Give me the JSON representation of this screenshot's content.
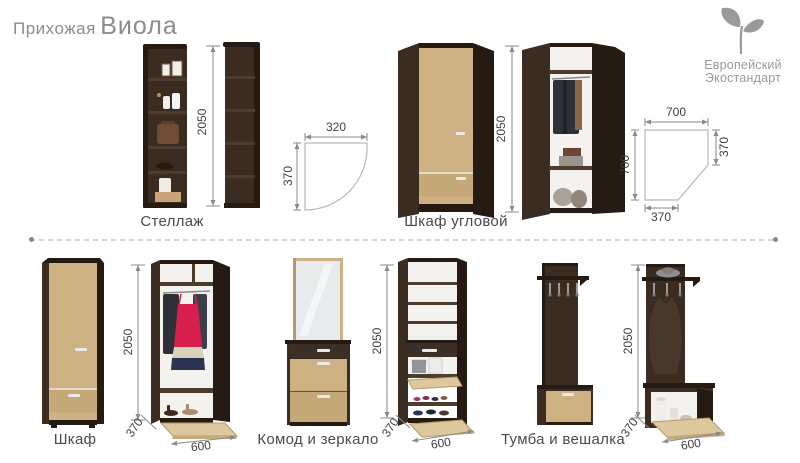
{
  "title": {
    "prefix": "Прихожая",
    "name": "Виола"
  },
  "logo": {
    "line1": "Европейский",
    "line2": "Экостандарт"
  },
  "colors": {
    "wenge": "#3a2c21",
    "wengeDark": "#261b12",
    "wengeMid": "#4d3b2b",
    "oak": "#cdb183",
    "oakDark": "#c5a878",
    "oakLight": "#ddc79c",
    "oakEdge": "#b59a6e",
    "interior": "#f3f2ef",
    "handle": "#e9e9e9",
    "metal": "#9a9a9a",
    "dim_line": "#8a8a8a",
    "dim_text": "#3f3f3f",
    "label": "#4a4a4a",
    "title": "#8c8c8c",
    "logo": "#9a9a9a",
    "divider": "#d5d5d5",
    "page_bg": "#ffffff",
    "red_dress": "#d61f4c",
    "navy": "#2c3350",
    "beige": "#d9d2ba",
    "dark_cloth": "#2f3138",
    "coat": "#47382e",
    "bag": "#6f4c36",
    "basket": "#c8a478"
  },
  "items": {
    "stellazh": {
      "label": "Стеллаж",
      "dim_height": "2050",
      "plan_width": "320",
      "plan_depth": "370"
    },
    "corner": {
      "label": "Шкаф угловой",
      "dim_height": "2050",
      "plan_top": "700",
      "plan_right": "370",
      "plan_left": "700",
      "plan_bottom": "370"
    },
    "shkaf": {
      "label": "Шкаф",
      "dim_height": "2050",
      "dim_depth": "370",
      "dim_width": "600"
    },
    "komod": {
      "label": "Комод и зеркало",
      "dim_height": "2050",
      "dim_depth": "370",
      "dim_width": "600"
    },
    "tumba": {
      "label": "Тумба и вешалка",
      "dim_height": "2050",
      "dim_depth": "370",
      "dim_width": "600"
    }
  }
}
